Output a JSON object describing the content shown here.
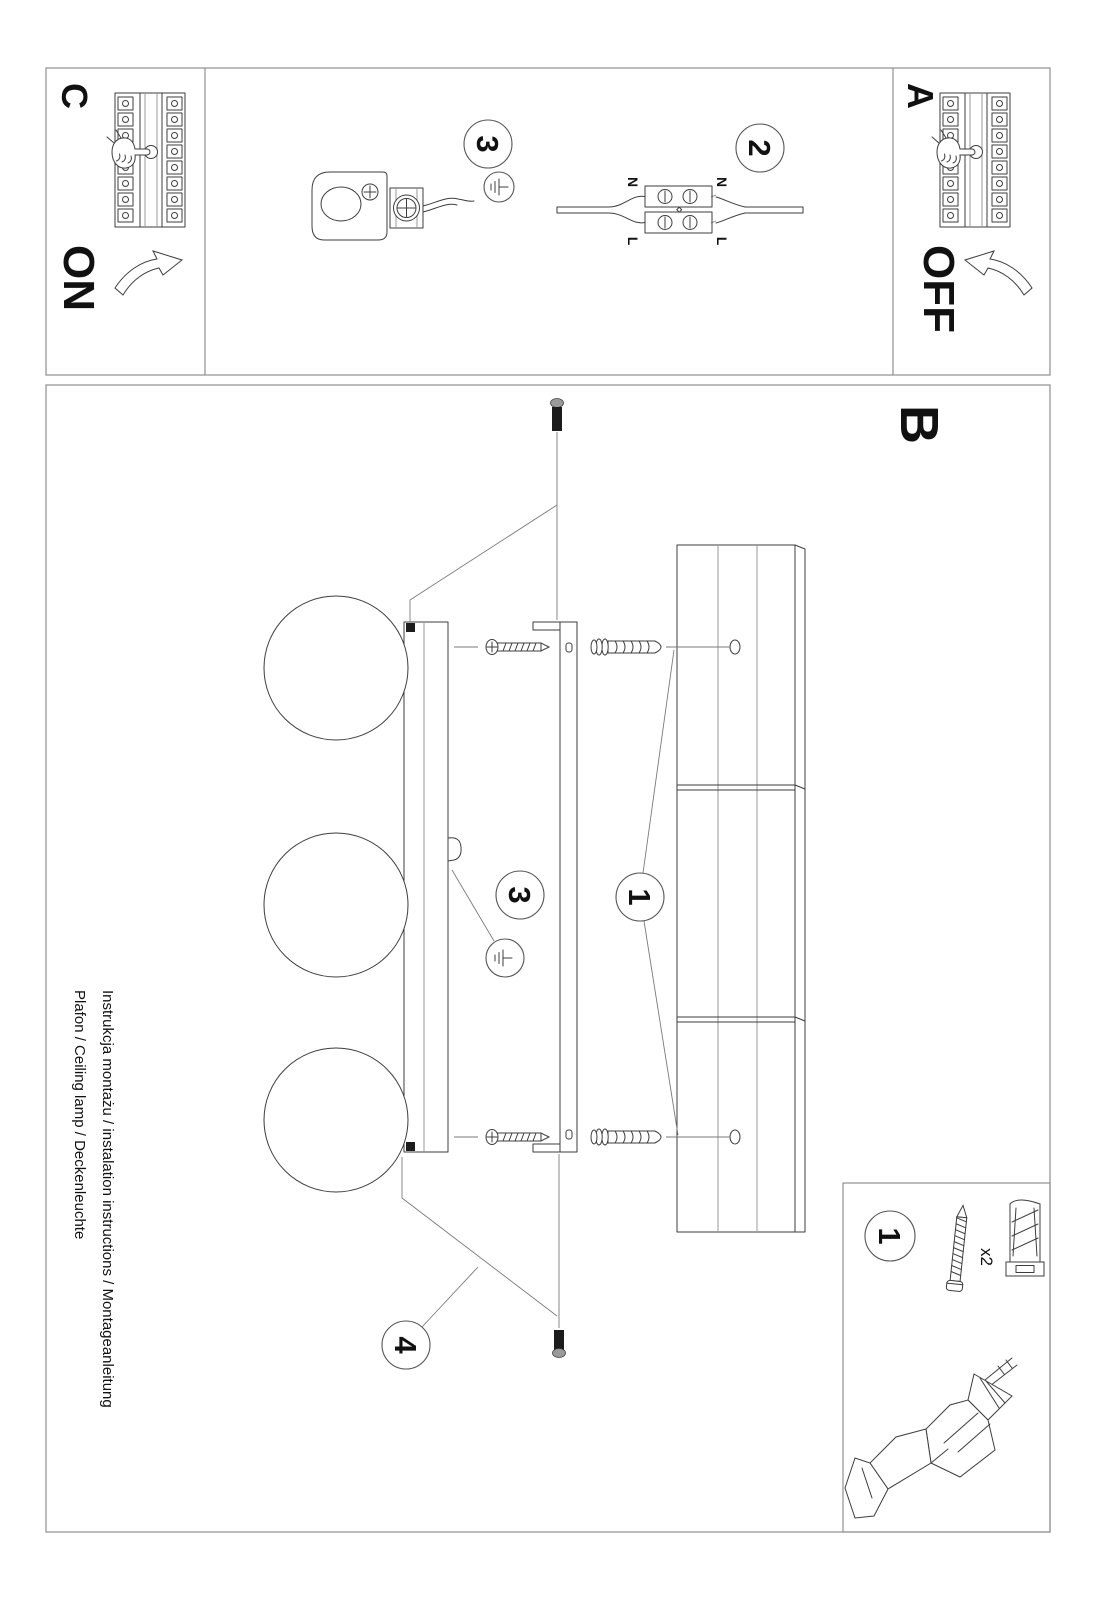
{
  "titles": {
    "line1": "Instrukcja montażu / instalation instructions / Montageanleitung",
    "line2": "Plafon / Ceiling lamp / Deckenleuchte"
  },
  "sections": {
    "a_label": "A",
    "b_label": "B",
    "c_label": "C",
    "off_text": "OFF",
    "on_text": "ON"
  },
  "callouts": {
    "panel_step": "1",
    "wiring_step": "2",
    "ground_step_top": "3",
    "ground_step_main": "3",
    "screw_step": "4",
    "hardware_kit_step": "1"
  },
  "wiring": {
    "top_n": "N",
    "top_l": "L",
    "bottom_n": "N",
    "bottom_l": "L"
  },
  "hardware": {
    "plug_qty": "x2"
  },
  "colors": {
    "paper": "#ffffff",
    "border": "#8f8f8f",
    "line": "#3d3d3d",
    "leader": "#7a7a7a",
    "dark_fill": "#1c1c1c",
    "metal_gray": "#9a9a9a"
  }
}
